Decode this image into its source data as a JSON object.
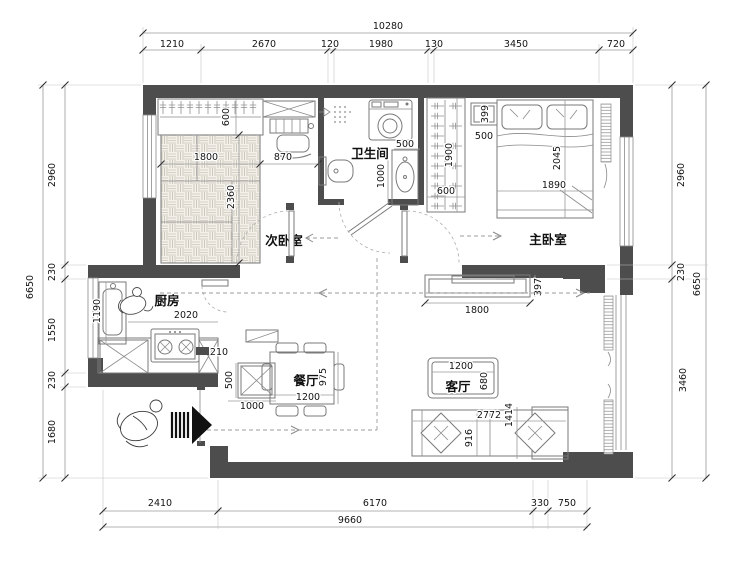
{
  "rooms": {
    "secondary_bedroom": "次卧室",
    "bathroom": "卫生间",
    "master_bedroom": "主卧室",
    "kitchen": "厨房",
    "dining": "餐厅",
    "living": "客厅"
  },
  "dims": {
    "top_total": "10280",
    "top": [
      "1210",
      "2670",
      "120",
      "1980",
      "130",
      "3450",
      "720"
    ],
    "left_total": "6650",
    "left": [
      "2960",
      "230",
      "1550",
      "230",
      "1680"
    ],
    "right_total": "6650",
    "right": [
      "2960",
      "230",
      "3460"
    ],
    "bottom_total": "9660",
    "bottom": [
      "2410",
      "6170",
      "330",
      "750"
    ]
  },
  "furniture": {
    "closet_depth": "600",
    "tatami_w": "1800",
    "tatami_l": "2360",
    "desk_w": "870",
    "bath_niche_w": "500",
    "bath_vanity_l": "1000",
    "wardrobe_l": "1900",
    "wardrobe_d": "600",
    "nightstand_d": "399",
    "nightstand_w": "500",
    "bed_l": "2045",
    "bed_w": "1890",
    "kitchen_counter_l": "1190",
    "kitchen_w": "2020",
    "kitchen_end": "210",
    "dining_cabinet_d": "500",
    "dining_cabinet_w": "1000",
    "dining_table_l": "975",
    "dining_table_w": "1200",
    "tv_stand_w": "1800",
    "tv_stand_d": "397",
    "coffee_table_w": "1200",
    "coffee_table_d": "680",
    "sofa_w": "2772",
    "sofa_d": "916",
    "sofa_chaise_l": "1414"
  },
  "colors": {
    "wall": "#4d4d4d",
    "line": "#7a7a7a",
    "dim_text": "#141414"
  }
}
